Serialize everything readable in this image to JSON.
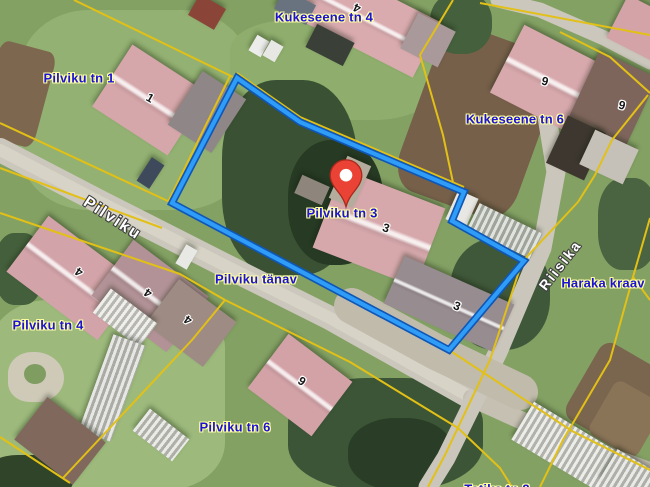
{
  "map": {
    "marker": {
      "label": "Pilviku tn 3",
      "color": "#ea4335",
      "stroke": "#a8291c"
    },
    "parcel": {
      "name": "Pilviku tn 3 boundary",
      "points": "237,78 300,122 464,192 452,221 524,261 449,350 172,203",
      "color_inner": "#2f9df8",
      "color_casing": "#0f57b6"
    },
    "colors": {
      "cadastral_yellow": "#e2c016",
      "label_blue": "#1c13d6",
      "label_halo": "#ffffa0",
      "street_text": "#ffffff",
      "road": "#ccc7bc",
      "grass": "#84a164"
    },
    "address_labels": [
      {
        "text": "Kukeseene tn 4",
        "x": 324,
        "y": 17
      },
      {
        "text": "Pilviku tn 1",
        "x": 79,
        "y": 78
      },
      {
        "text": "Kukeseene tn 6",
        "x": 515,
        "y": 119
      },
      {
        "text": "Pilviku tn 3",
        "x": 342,
        "y": 213
      },
      {
        "text": "Pilviku tänav",
        "x": 256,
        "y": 279
      },
      {
        "text": "Pilviku tn 4",
        "x": 48,
        "y": 325
      },
      {
        "text": "Pilviku tn 6",
        "x": 235,
        "y": 427
      },
      {
        "text": "Haraka kraav",
        "x": 603,
        "y": 283
      },
      {
        "text": "Tatika tn 2",
        "x": 497,
        "y": 489,
        "partial": true
      }
    ],
    "street_labels": [
      {
        "text": "Pilviku",
        "x": 112,
        "y": 219,
        "rot": 33,
        "size": 16
      },
      {
        "text": "Riisika",
        "x": 560,
        "y": 265,
        "rot": -52,
        "size": 14
      }
    ],
    "building_numbers": [
      {
        "text": "1",
        "x": 150,
        "y": 98,
        "rot": 30
      },
      {
        "text": "4",
        "x": 357,
        "y": 8,
        "rot": 205
      },
      {
        "text": "6",
        "x": 545,
        "y": 81,
        "rot": 195
      },
      {
        "text": "6",
        "x": 622,
        "y": 105,
        "rot": 195
      },
      {
        "text": "3",
        "x": 386,
        "y": 228,
        "rot": 18
      },
      {
        "text": "3",
        "x": 457,
        "y": 306,
        "rot": 22
      },
      {
        "text": "4",
        "x": 79,
        "y": 272,
        "rot": 215
      },
      {
        "text": "4",
        "x": 148,
        "y": 293,
        "rot": 215
      },
      {
        "text": "4",
        "x": 188,
        "y": 320,
        "rot": 215
      },
      {
        "text": "6",
        "x": 302,
        "y": 381,
        "rot": 215
      }
    ],
    "terrain": [
      {
        "n": "lawn-topleft",
        "x": 20,
        "y": 10,
        "w": 230,
        "h": 200,
        "r": 0,
        "c": "#93b172",
        "rad": 30
      },
      {
        "n": "lawn-bottomleft",
        "x": -10,
        "y": 300,
        "w": 235,
        "h": 190,
        "r": 0,
        "c": "#9dba7c",
        "rad": 25
      },
      {
        "n": "lawn-topcenter",
        "x": 230,
        "y": 20,
        "w": 205,
        "h": 100,
        "r": 0,
        "c": "#8fae6d",
        "rad": 30
      },
      {
        "n": "field-topright",
        "x": 415,
        "y": 35,
        "w": 125,
        "h": 175,
        "r": 20,
        "c": "#76604a",
        "rad": 20
      },
      {
        "n": "field-right",
        "x": 578,
        "y": 352,
        "w": 78,
        "h": 88,
        "r": 30,
        "c": "#7a654e",
        "rad": 15
      },
      {
        "n": "field-rows-topleft",
        "x": -12,
        "y": 45,
        "w": 58,
        "h": 98,
        "r": 15,
        "c": "#7d684f",
        "rad": 15
      },
      {
        "n": "trees-parcel-west",
        "x": 222,
        "y": 80,
        "w": 135,
        "h": 195,
        "r": 0,
        "c": "#3a5233",
        "rad": 40
      },
      {
        "n": "trees-parcel-dark",
        "x": 288,
        "y": 140,
        "w": 95,
        "h": 125,
        "r": 0,
        "c": "#273a24",
        "rad": 45
      },
      {
        "n": "trees-east",
        "x": 450,
        "y": 238,
        "w": 100,
        "h": 112,
        "r": 0,
        "c": "#40583a",
        "rad": 45
      },
      {
        "n": "trees-bottom",
        "x": 288,
        "y": 378,
        "w": 195,
        "h": 112,
        "r": 0,
        "c": "#3c5536",
        "rad": 40
      },
      {
        "n": "trees-bottom-dark",
        "x": 348,
        "y": 418,
        "w": 105,
        "h": 72,
        "r": 0,
        "c": "#2a3d26",
        "rad": 45
      },
      {
        "n": "hedge-bottomleft",
        "x": -12,
        "y": 455,
        "w": 85,
        "h": 42,
        "r": 0,
        "c": "#2f4429",
        "rad": 35
      },
      {
        "n": "bushes-top",
        "x": 430,
        "y": -8,
        "w": 62,
        "h": 62,
        "r": 0,
        "c": "#45603c",
        "rad": 45
      },
      {
        "n": "trees-rightedge",
        "x": 598,
        "y": 178,
        "w": 60,
        "h": 92,
        "r": 0,
        "c": "#4a6340",
        "rad": 40
      },
      {
        "n": "garden-right-rows",
        "x": 598,
        "y": 388,
        "w": 56,
        "h": 62,
        "r": 30,
        "c": "#8a7458",
        "rad": 15
      },
      {
        "n": "trees-left-p4",
        "x": -5,
        "y": 233,
        "w": 48,
        "h": 72,
        "r": 0,
        "c": "#445f3b",
        "rad": 40
      }
    ],
    "roads": [
      {
        "n": "pilviku-road",
        "pts": "0,150 100,202 230,268 330,318 472,398",
        "w": 24,
        "c": "#ccc7bc"
      },
      {
        "n": "pilviku-road-center",
        "pts": "0,150 100,202 230,268 330,318 472,398",
        "w": 12,
        "c": "#d8d3c7"
      },
      {
        "n": "road-southeast",
        "pts": "472,398 560,438 652,472",
        "w": 18,
        "c": "#c6c0b3"
      },
      {
        "n": "riisika-road",
        "pts": "543,92 556,172 542,248 498,352 446,458 428,487",
        "w": 19,
        "c": "#cbc6bb"
      },
      {
        "n": "topright-road",
        "pts": "498,0 540,10 604,38 650,62",
        "w": 15,
        "c": "#ccc7bc"
      },
      {
        "n": "gravel-yard",
        "pts": "352,306 436,352 520,392",
        "w": 36,
        "c": "#c1bbac"
      }
    ],
    "buildings": [
      {
        "n": "kukeseene4-house",
        "x": 360,
        "y": 16,
        "w": 150,
        "h": 62,
        "r": 27,
        "c": "#d9abaf",
        "ridge": true
      },
      {
        "n": "kukeseene4-annex",
        "x": 428,
        "y": 40,
        "w": 42,
        "h": 40,
        "r": 27,
        "c": "#a9999b"
      },
      {
        "n": "shed-top-red",
        "x": 207,
        "y": 12,
        "w": 30,
        "h": 24,
        "r": 30,
        "c": "#8a4438"
      },
      {
        "n": "shed-top-gray",
        "x": 295,
        "y": 7,
        "w": 36,
        "h": 22,
        "r": 27,
        "c": "#68737f"
      },
      {
        "n": "pilviku1-house",
        "x": 150,
        "y": 100,
        "w": 90,
        "h": 74,
        "r": 33,
        "c": "#d5a6aa",
        "ridge": true
      },
      {
        "n": "pilviku1-annex",
        "x": 207,
        "y": 112,
        "w": 52,
        "h": 64,
        "r": 33,
        "c": "#8f8688"
      },
      {
        "n": "kukeseene6-house",
        "x": 549,
        "y": 80,
        "w": 94,
        "h": 76,
        "r": 27,
        "c": "#d7a8ac",
        "ridge": true
      },
      {
        "n": "kukeseene6-annex",
        "x": 613,
        "y": 98,
        "w": 64,
        "h": 74,
        "r": 25,
        "c": "#7e655c"
      },
      {
        "n": "topright-pink-roof",
        "x": 644,
        "y": 30,
        "w": 60,
        "h": 48,
        "r": 27,
        "c": "#d3a3a7"
      },
      {
        "n": "shed-dark-right",
        "x": 576,
        "y": 148,
        "w": 42,
        "h": 52,
        "r": 25,
        "c": "#3d372f"
      },
      {
        "n": "concrete-pad",
        "x": 609,
        "y": 157,
        "w": 48,
        "h": 38,
        "r": 25,
        "c": "#c6c1b8"
      },
      {
        "n": "pilviku3-main-house",
        "x": 379,
        "y": 228,
        "w": 110,
        "h": 84,
        "r": 21,
        "c": "#d6a8ac",
        "ridge": true
      },
      {
        "n": "pilviku3-second-building",
        "x": 449,
        "y": 304,
        "w": 120,
        "h": 52,
        "r": 24,
        "c": "#978c90",
        "ridge": true
      },
      {
        "n": "shed-white-notch",
        "x": 462,
        "y": 209,
        "w": 22,
        "h": 32,
        "r": 24,
        "c": "#e9e7e3"
      },
      {
        "n": "greenhouse-ne",
        "x": 505,
        "y": 231,
        "w": 70,
        "h": 28,
        "r": 26,
        "c": "#b9bfb4",
        "stripes": true
      },
      {
        "n": "pilviku4-main-house",
        "x": 73,
        "y": 278,
        "w": 114,
        "h": 70,
        "r": 37,
        "c": "#d2a3a8",
        "ridge": true
      },
      {
        "n": "pilviku4-mid-house",
        "x": 150,
        "y": 296,
        "w": 94,
        "h": 70,
        "r": 37,
        "c": "#b29296",
        "ridge": true
      },
      {
        "n": "pilviku4-right-wing",
        "x": 191,
        "y": 323,
        "w": 72,
        "h": 56,
        "r": 37,
        "c": "#9e8b84"
      },
      {
        "n": "pilviku4-glass-annex",
        "x": 125,
        "y": 318,
        "w": 58,
        "h": 30,
        "r": 37,
        "c": "#dddcd6",
        "stripes": true
      },
      {
        "n": "pilviku6-house",
        "x": 300,
        "y": 385,
        "w": 80,
        "h": 68,
        "r": 37,
        "c": "#d2a2a7",
        "ridge": true
      },
      {
        "n": "greenhouse-left",
        "x": 112,
        "y": 388,
        "w": 34,
        "h": 102,
        "r": 20,
        "c": "#c9c9c3",
        "stripes": true
      },
      {
        "n": "shed-bottomleft",
        "x": 60,
        "y": 441,
        "w": 74,
        "h": 54,
        "r": 38,
        "c": "#80695c"
      },
      {
        "n": "greenhouse-small",
        "x": 161,
        "y": 435,
        "w": 50,
        "h": 28,
        "r": 38,
        "c": "#d0d0ca",
        "stripes": true
      },
      {
        "n": "greenhouse-bottomright",
        "x": 575,
        "y": 452,
        "w": 122,
        "h": 44,
        "r": 31,
        "c": "#d4d4ce",
        "stripes": true
      },
      {
        "n": "greenhouse-bottomright-2",
        "x": 634,
        "y": 480,
        "w": 60,
        "h": 36,
        "r": 31,
        "c": "#cfcfc9",
        "stripes": true
      },
      {
        "n": "car-dark",
        "x": 150,
        "y": 173,
        "w": 15,
        "h": 28,
        "r": 33,
        "c": "#3e4a5c"
      },
      {
        "n": "van-white",
        "x": 186,
        "y": 257,
        "w": 13,
        "h": 22,
        "r": 30,
        "c": "#e8e8e4"
      },
      {
        "n": "white-box-1",
        "x": 259,
        "y": 46,
        "w": 14,
        "h": 18,
        "r": 30,
        "c": "#ececea"
      },
      {
        "n": "white-box-2",
        "x": 273,
        "y": 51,
        "w": 14,
        "h": 18,
        "r": 30,
        "c": "#e7e7e3"
      },
      {
        "n": "yard-clutter",
        "x": 330,
        "y": 45,
        "w": 42,
        "h": 26,
        "r": 27,
        "c": "#3a4038"
      },
      {
        "n": "woodpile",
        "x": 350,
        "y": 182,
        "w": 26,
        "h": 46,
        "r": 24,
        "c": "#b4ac9c"
      },
      {
        "n": "shed-in-parcel",
        "x": 312,
        "y": 190,
        "w": 30,
        "h": 20,
        "r": 24,
        "c": "#8e867d"
      }
    ],
    "cadastral_lines": [
      {
        "pts": "74,0 233,77"
      },
      {
        "pts": "0,123 170,202"
      },
      {
        "pts": "230,76 168,202"
      },
      {
        "pts": "237,73 300,117 464,187"
      },
      {
        "pts": "0,168 162,228"
      },
      {
        "pts": "0,213 50,230 180,274 225,300"
      },
      {
        "pts": "225,300 350,362 458,428 500,468 512,487"
      },
      {
        "pts": "225,300 192,340 63,478"
      },
      {
        "pts": "0,437 70,483"
      },
      {
        "pts": "449,350 572,431 652,471"
      },
      {
        "pts": "578,202 522,262 490,360 445,455 428,487"
      },
      {
        "pts": "650,218 633,277 610,360 563,440 540,487"
      },
      {
        "pts": "633,277 650,300"
      },
      {
        "pts": "480,3 650,35"
      },
      {
        "pts": "560,32 610,57 650,93"
      },
      {
        "pts": "648,95 612,140 595,175 578,202"
      },
      {
        "pts": "453,0 420,55 443,135 455,192"
      }
    ]
  }
}
